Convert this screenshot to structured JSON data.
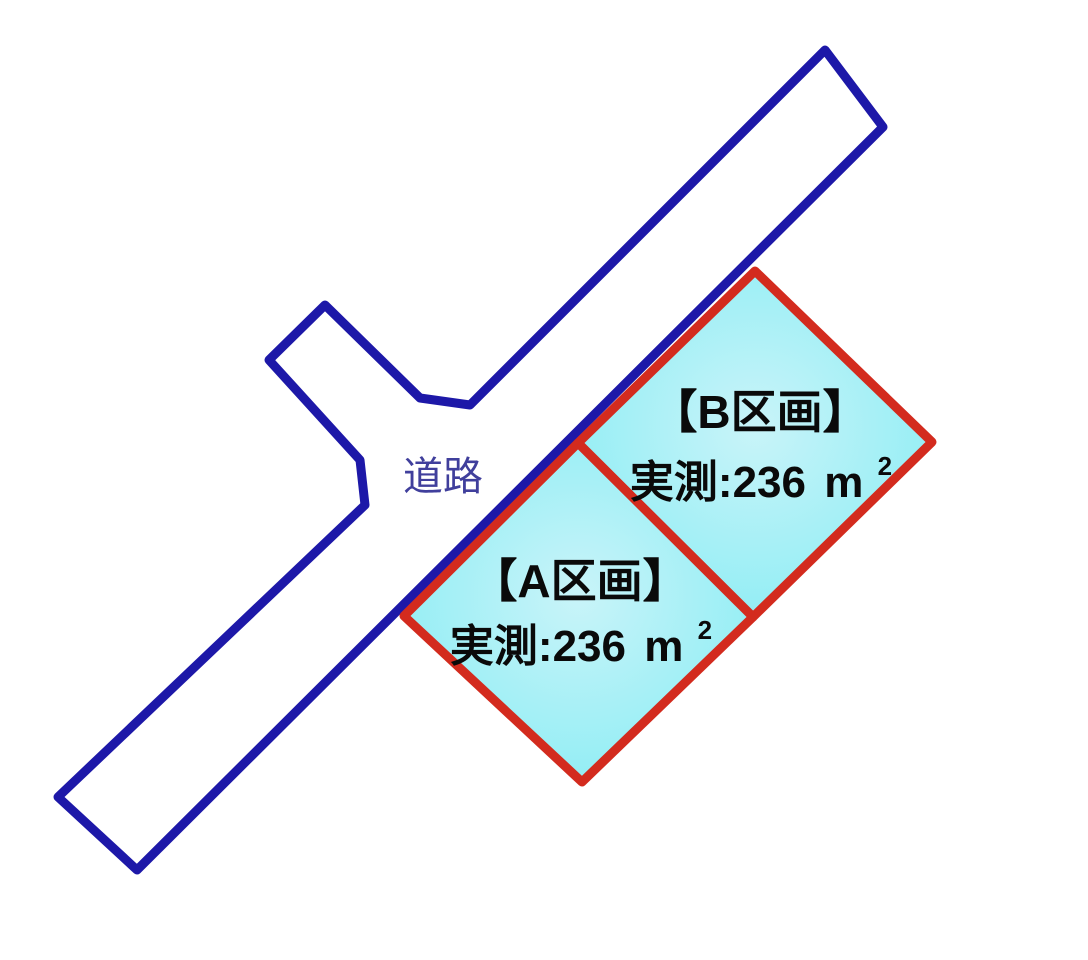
{
  "diagram": {
    "type": "land-plot-map",
    "background_color": "#ffffff"
  },
  "road": {
    "label": "道路",
    "stroke_color": "#1d18a8",
    "fill_color": "#ffffff",
    "label_color": "#403f9c"
  },
  "plots": [
    {
      "id": "A",
      "name_label": "【A区画】",
      "area_label": "実測:236",
      "area_unit": "m",
      "area_exponent": "2",
      "fill_center": "#c9f4f9",
      "fill_edge": "#84ecf3",
      "border_color": "#d32b1e"
    },
    {
      "id": "B",
      "name_label": "【B区画】",
      "area_label": "実測:236",
      "area_unit": "m",
      "area_exponent": "2",
      "fill_center": "#c9f4f9",
      "fill_edge": "#84ecf3",
      "border_color": "#d32b1e"
    }
  ]
}
